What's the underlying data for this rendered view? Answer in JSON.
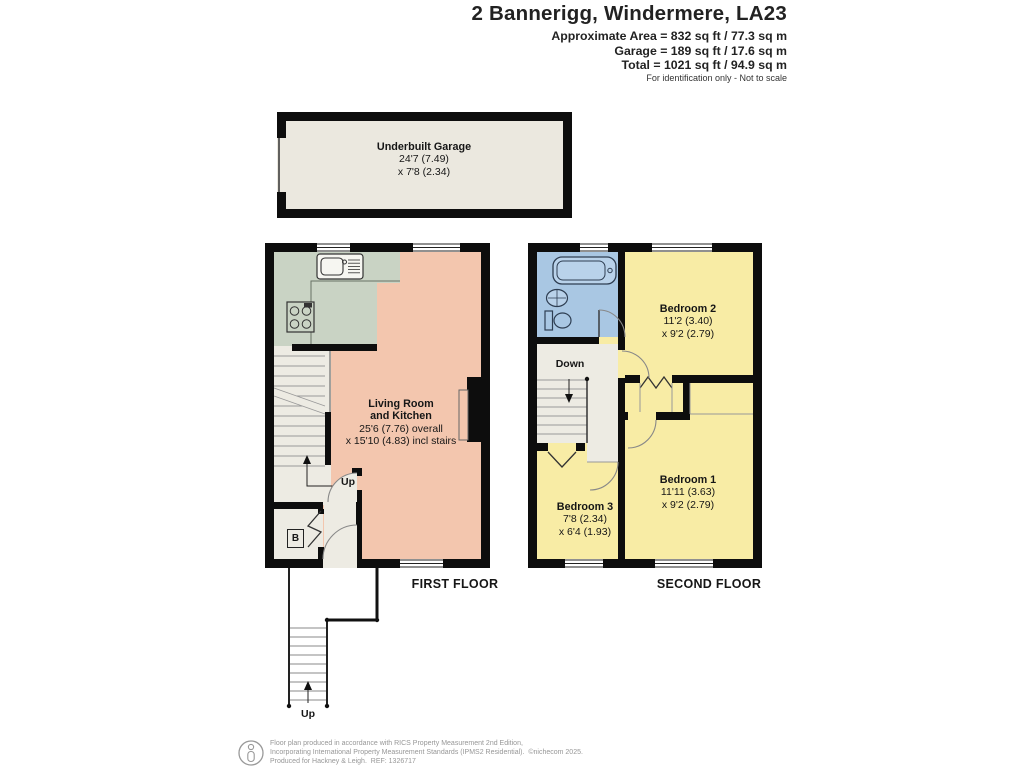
{
  "header": {
    "title": "2 Bannerigg, Windermere, LA23",
    "area_line1": "Approximate Area = 832 sq ft / 77.3 sq m",
    "area_line2": "Garage = 189 sq ft / 17.6 sq m",
    "area_line3": "Total = 1021 sq ft / 94.9 sq m",
    "disclaimer": "For identification only - Not to scale"
  },
  "garage": {
    "room": {
      "name": "Underbuilt Garage",
      "dim1": "24'7 (7.49)",
      "dim2": "x 7'8 (2.34)"
    }
  },
  "first_floor": {
    "label": "FIRST FLOOR",
    "living_room": {
      "name_line1": "Living Room",
      "name_line2": "and Kitchen",
      "dim1": "25'6 (7.76) overall",
      "dim2": "x 15'10 (4.83) incl stairs"
    },
    "up_label": "Up",
    "boiler_label": "B",
    "external_stairs_up_label": "Up"
  },
  "second_floor": {
    "label": "SECOND FLOOR",
    "down_label": "Down",
    "bedroom1": {
      "name": "Bedroom 1",
      "dim1": "11'11 (3.63)",
      "dim2": "x 9'2 (2.79)"
    },
    "bedroom2": {
      "name": "Bedroom 2",
      "dim1": "11'2 (3.40)",
      "dim2": "x 9'2 (2.79)"
    },
    "bedroom3": {
      "name": "Bedroom 3",
      "dim1": "7'8 (2.34)",
      "dim2": "x 6'4 (1.93)"
    }
  },
  "footer": {
    "line1": "Floor plan produced in accordance with RICS Property Measurement 2nd Edition,",
    "line2": "Incorporating International Property Measurement Standards (IPMS2 Residential).  ©nichecom 2025.",
    "line3": "Produced for Hackney & Leigh.  REF: 1326717"
  },
  "colors": {
    "wall": "#0d0d0d",
    "salmon": "#f3c6ae",
    "kitchen": "#c9d3c4",
    "yellow": "#f8eca5",
    "blue": "#a9c7e3",
    "cream": "#edebe3",
    "garage": "#ebe8df"
  }
}
